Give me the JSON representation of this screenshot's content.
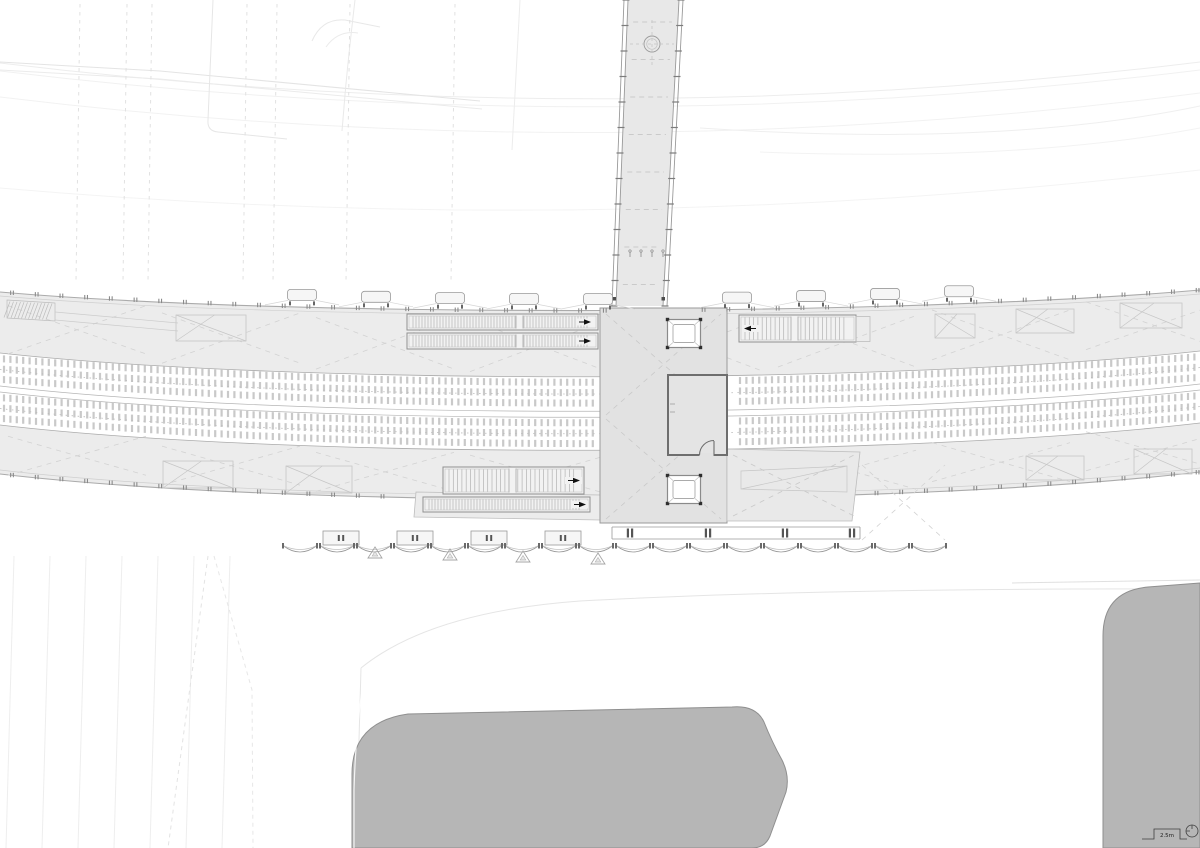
{
  "drawing": {
    "scale_bar": {
      "label": "2.5m"
    },
    "palette": {
      "background": "#ffffff",
      "platform": "#ececec",
      "concourse": "#e2e2e2",
      "concourse_ext": "#e9e9e9",
      "bridge_deck": "#e8e8e8",
      "room_fill": "#e4e4e4",
      "stair_fill": "#f2f2f2",
      "canopy_fill": "#f6f6f6",
      "building": "#b6b6b6",
      "building_outline": "#8f8f8f",
      "outline_strong": "#9a9a9a",
      "outline_medium": "#ababab",
      "outline_faint": "#c6c6c6",
      "sleeper": "#c9c9c9",
      "brace_dash": "#d2d2d2",
      "detail_dark": "#555555",
      "arrow_dark": "#111111"
    }
  }
}
